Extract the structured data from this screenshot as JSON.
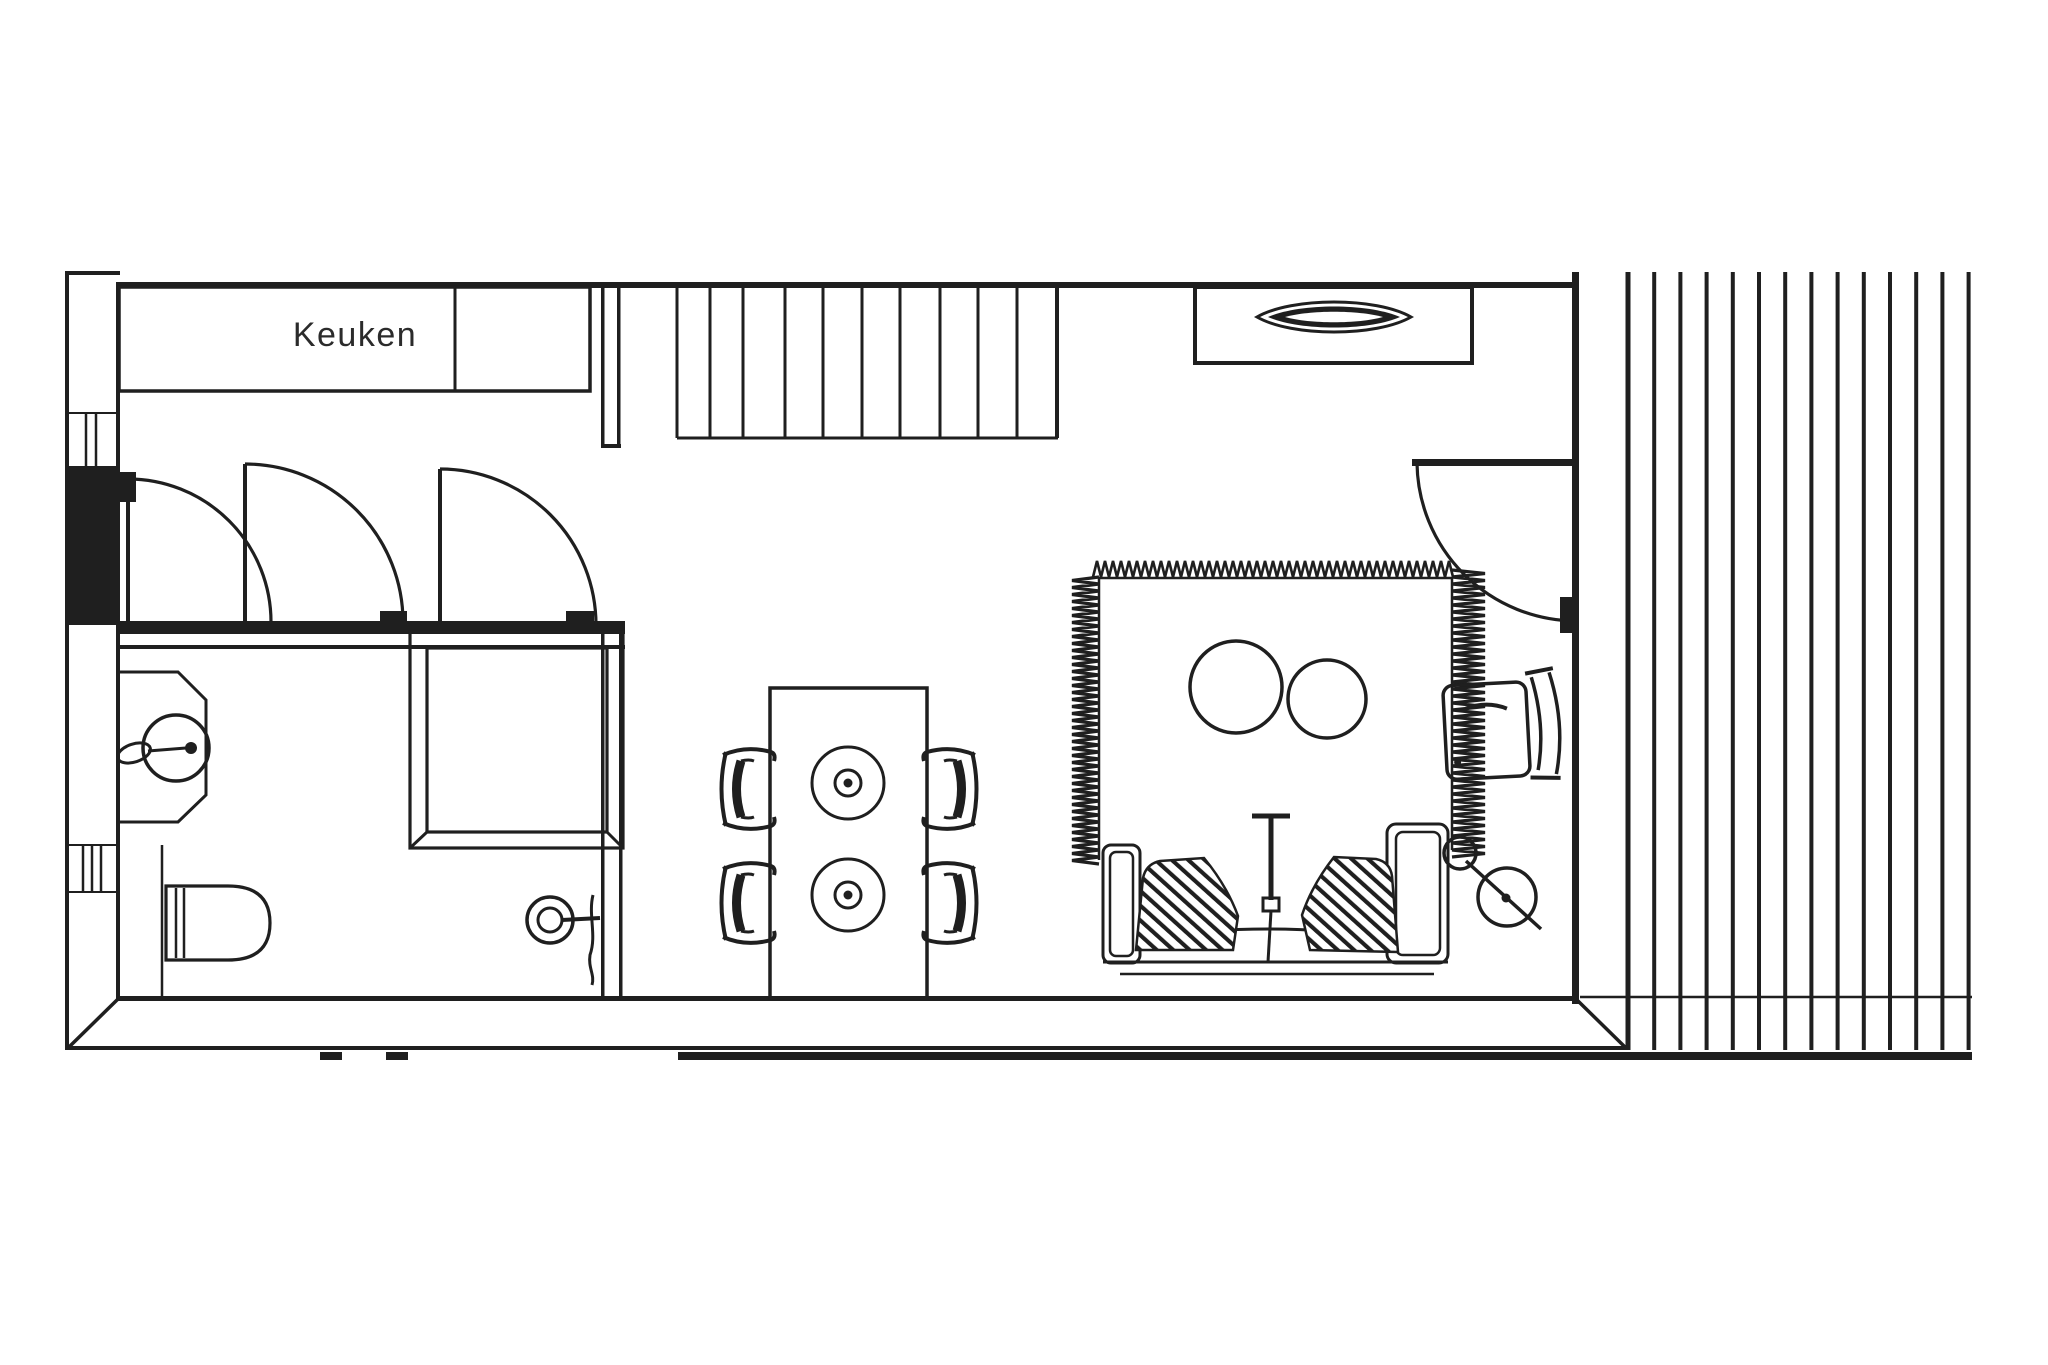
{
  "labels": {
    "kitchen": "Keuken"
  },
  "colors": {
    "ink": "#1f1f1f",
    "background": "#ffffff"
  },
  "plan": {
    "type": "apartment-floor-plan",
    "rooms": [
      "kitchen",
      "hallway",
      "bathroom",
      "living-dining-room",
      "terrace-deck"
    ],
    "furniture_symbols": [
      "kitchen-counter",
      "staircase",
      "interior-door",
      "interior-door",
      "interior-door",
      "entrance-door",
      "console-table",
      "decor-bowl",
      "shower-enclosure",
      "washbasin",
      "faucet",
      "toilet",
      "door-handle",
      "dining-table",
      "dining-chair",
      "dining-chair",
      "dining-chair",
      "dining-chair",
      "centerpiece",
      "centerpiece",
      "rug",
      "coffee-table-round",
      "coffee-table-round",
      "sofa",
      "cushion",
      "cushion",
      "floor-lamp",
      "arc-lamp",
      "armchair",
      "decking-boards"
    ]
  },
  "geometry": {
    "deck": {
      "x_start": 1628,
      "step": 26.2,
      "count": 14,
      "y_top": 272,
      "y_bottom": 1050,
      "width": 4
    },
    "stairs": {
      "treads": [
        677,
        710,
        743,
        785,
        823,
        862,
        900,
        940,
        978,
        1017
      ],
      "y_top": 288,
      "y_bottom": 438,
      "width": 3
    },
    "fringes": [
      {
        "dir": "v",
        "x_in": 1099,
        "x_out": 1072,
        "y0": 577,
        "y1": 862,
        "step": 7,
        "width": 3.2
      },
      {
        "dir": "v",
        "x_in": 1452,
        "x_out": 1485,
        "y0": 570,
        "y1": 852,
        "step": 7,
        "width": 3.2
      },
      {
        "dir": "h",
        "y_in": 577,
        "y_out": 561,
        "x0": 1093,
        "x1": 1452,
        "step": 8,
        "width": 2.6
      }
    ]
  }
}
